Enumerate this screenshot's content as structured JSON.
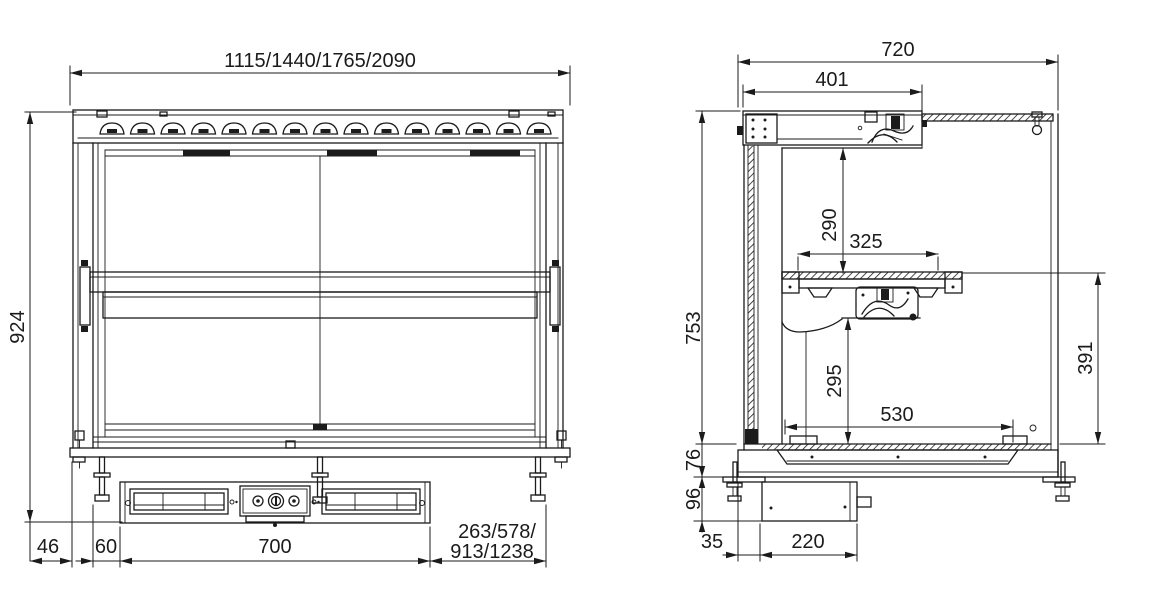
{
  "drawing": {
    "title": "display-case-dimensional-drawing",
    "colors": {
      "line": "#1b1b1b",
      "background": "#ffffff"
    },
    "front_view": {
      "dims": {
        "overall_width": "1115/1440/1765/2090",
        "overall_height": "924",
        "left_offset": "46",
        "left_inset": "60",
        "cutout_width": "700",
        "right_segment_line1": "263/578/",
        "right_segment_line2": "913/1238"
      }
    },
    "side_view": {
      "dims": {
        "overall_depth": "720",
        "canopy_depth": "401",
        "overall_height": "753",
        "canopy_to_shelf": "290",
        "shelf_depth": "325",
        "well_height": "295",
        "well_width": "530",
        "shelf_to_floor": "391",
        "base_height": "76",
        "undermount_height": "96",
        "front_offset": "35",
        "control_box_depth": "220"
      }
    }
  }
}
